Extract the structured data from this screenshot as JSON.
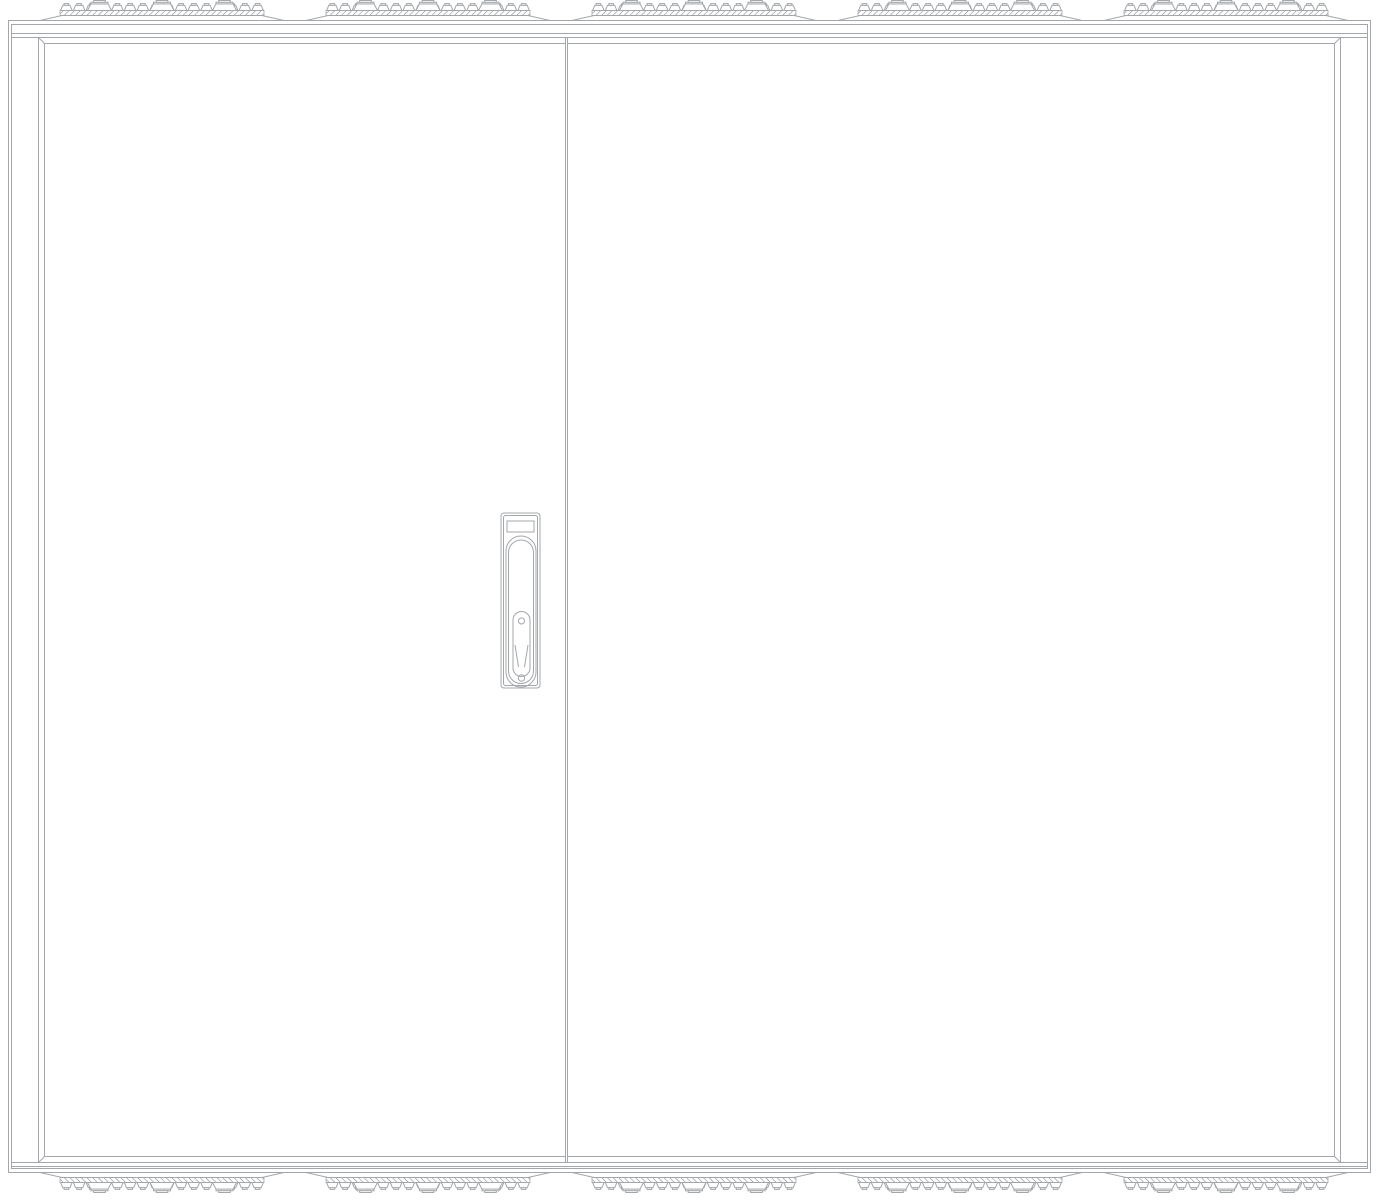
{
  "page": {
    "background": "#ffffff",
    "title": "Double-door electrical enclosure, front elevation (CAD line drawing)"
  },
  "drawing": {
    "type": "technical-line-drawing",
    "subject": "floor-standing two-door switchgear cabinet, front view",
    "stroke_color": "#a3a7ab",
    "stroke_color_dark": "#888d92",
    "hatch_color": "#7e848a",
    "surface_color": "#ffffff",
    "doors": {
      "count": 2,
      "handle_on": "left-door",
      "divider": true
    },
    "handle": {
      "style": "recessed-swing-handle",
      "pivot_screw": true,
      "lock_screw": true
    },
    "cable_entry": {
      "rows": [
        "top",
        "bottom"
      ],
      "groups_per_row": 5,
      "small_glands_per_group": 16,
      "large_glands_per_group": 3,
      "seal": "brush-hatch-strip"
    }
  }
}
